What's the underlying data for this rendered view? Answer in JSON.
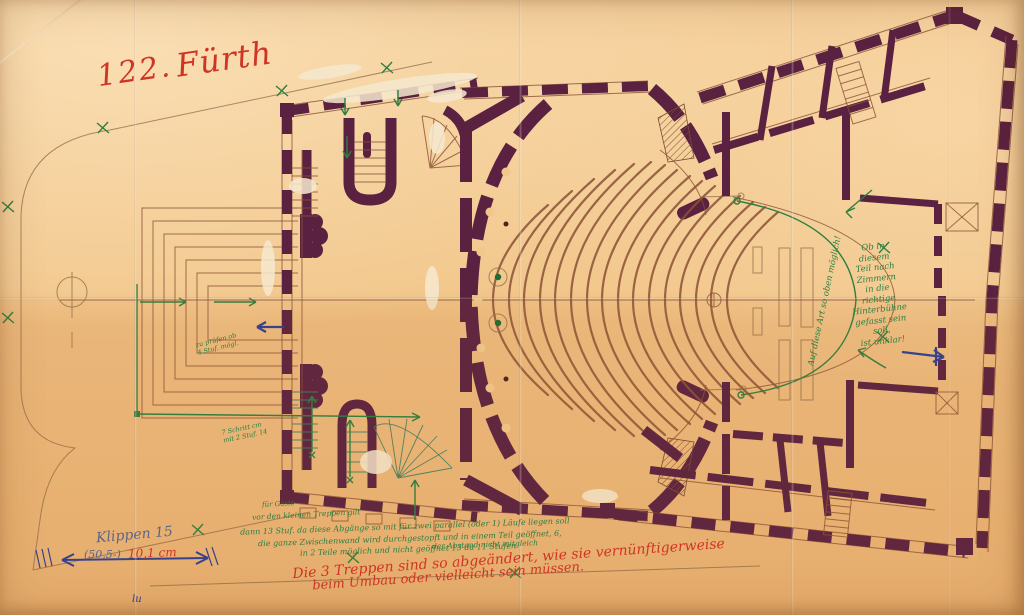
{
  "document": {
    "catalog_number": "122.",
    "city": "Fürth"
  },
  "annotations": {
    "note_right": "Ob in\ndiesem\nTeil nach\nZimmern\nin die richtige\nHinterbühne\ngefasst sein soll,\nist unklar!",
    "note_curve": "Auf diese Art so oben möglich!",
    "stage_note_a": "zu prüfen ob\n4 Stuf. mögl.",
    "stage_note_b": "7 Schritt cm\nmit 2 Stuf. 14",
    "bottom_green_lines": [
      "für Gäste",
      "vor den kleinen Treppen gilt",
      "dann 13 Stuf. da diese Abgänge so mit für zwei parallel (oder 1) Läufe liegen soll",
      "die ganze Zwischenwand wird durchgestopft und in einem Teil geöffnet, 6,",
      "in 2 Teile möglich und nicht geöffnet 13 da 11 Stufen",
      "der Abstand nicht mitgleich"
    ],
    "bottom_red_line1": "Die 3 Treppen sind so abgeändert, wie sie vernünftigerweise",
    "bottom_red_line2": "beim Umbau oder vielleicht sein müssen.",
    "pencil_label": "Klippen 15",
    "dimension_prefix": "(50,5-)",
    "dimension_value": "10,1 cm",
    "corner_mark": "lu"
  },
  "colors": {
    "paper": "#f2c78c",
    "wall_ink": "#5a2240",
    "line_ink": "#8a5136",
    "green_ink": "#2c7f41",
    "teal_ink": "#3e7d62",
    "red_ink": "#cf3524",
    "blue_ink": "#2e3f93",
    "pencil": "#5f6484",
    "whiteout": "#f6e9cf"
  }
}
